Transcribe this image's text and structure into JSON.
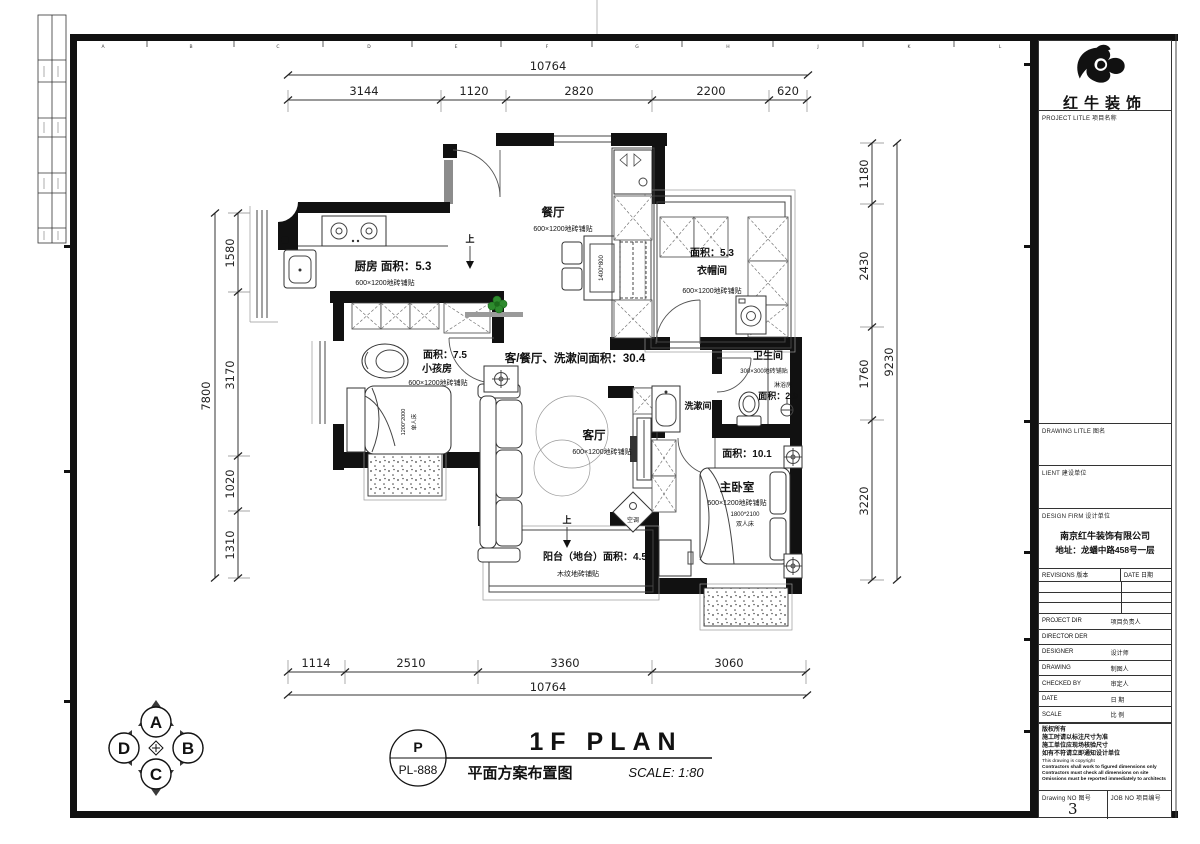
{
  "sheet": {
    "grid_letters": [
      "A",
      "B",
      "C",
      "D",
      "E",
      "F",
      "G",
      "H",
      "J",
      "K",
      "L"
    ]
  },
  "dimensions": {
    "top": {
      "total": "10764",
      "segments": [
        "3144",
        "1120",
        "2820",
        "2200",
        "620"
      ]
    },
    "bottom": {
      "total": "10764",
      "segments": [
        "1114",
        "2510",
        "3360",
        "3060"
      ]
    },
    "left": {
      "total": "7800",
      "segments": [
        "1580",
        "3170",
        "1020",
        "1310"
      ]
    },
    "right": {
      "total": "9230",
      "segments": [
        "1180",
        "2430",
        "1760",
        "3220"
      ]
    }
  },
  "plan": {
    "dining": {
      "name": "餐厅",
      "finish": "600×1200地砖铺贴",
      "table_size": "1400*800"
    },
    "kitchen": {
      "title": "厨房 面积：5.3",
      "finish": "600×1200地砖铺贴"
    },
    "cloakroom": {
      "area": "面积：5.3",
      "name": "衣帽间",
      "finish": "600×1200地砖铺贴"
    },
    "kids": {
      "area": "面积：7.5",
      "name": "小孩房",
      "finish": "600×1200地砖铺贴",
      "bed_size": "1200*2000",
      "bed_type": "单人床"
    },
    "hall_label": "客/餐厅、洗漱间面积：30.4",
    "living": {
      "name": "客厅",
      "finish": "600×1200地砖铺贴"
    },
    "washroom": {
      "name": "洗漱间"
    },
    "bathroom": {
      "name": "卫生间",
      "finish": "300×300地砖铺贴",
      "shower": "淋浴房",
      "shower_area": "面积：2.9"
    },
    "master": {
      "area": "面积：10.1",
      "name": "主卧室",
      "finish": "600×1200地砖铺贴",
      "bed_size": "1800*2100",
      "bed_type": "双人床"
    },
    "balcony": {
      "title": "阳台（地台）面积：4.5",
      "finish": "木纹地砖铺贴"
    },
    "ac": "空调",
    "up": "上"
  },
  "footer": {
    "code_top": "P",
    "code_bottom": "PL-888",
    "title_en": "1F PLAN",
    "title_cn": "平面方案布置图",
    "scale": "SCALE: 1:80"
  },
  "compass": {
    "top": "A",
    "right": "B",
    "bottom": "C",
    "left": "D"
  },
  "titleblock": {
    "brand": "红牛装饰",
    "project_label": "PROJECT LITLE  项目名称",
    "drawing_label": "DRAWING LITLE  图名",
    "client_label": "LIENT  建设单位",
    "firm_label": "DESIGN FIRM  设计单位",
    "company": "南京红牛装饰有限公司",
    "address": "地址：龙蟠中路458号一层",
    "revisions_label": "REVISIONS  版本",
    "rev_date_label": "DATE  日期",
    "rows": [
      {
        "en": "PROJECT DIR",
        "cn": "项目负责人"
      },
      {
        "en": "DIRECTOR DER",
        "cn": ""
      },
      {
        "en": "DESIGNER",
        "cn": "设计师"
      },
      {
        "en": "DRAWING",
        "cn": "制图人"
      },
      {
        "en": "CHECKED BY",
        "cn": "审定人"
      },
      {
        "en": "DATE",
        "cn": "日  期"
      },
      {
        "en": "SCALE",
        "cn": "比  例"
      }
    ],
    "notes": [
      "版权所有",
      "施工时请以标注尺寸为准",
      "施工单位应现场核验尺寸",
      "如有不符请立即通知设计单位",
      "This drawing is copyright",
      "Contractors shall work to figured dimensions only",
      "Contractors must check all dimensions on site",
      "Omissions must be reported immediately to architects"
    ],
    "drawing_no_label": "Drawing NO  图号",
    "drawing_no": "3",
    "job_no_label": "JOB NO  项目编号"
  }
}
